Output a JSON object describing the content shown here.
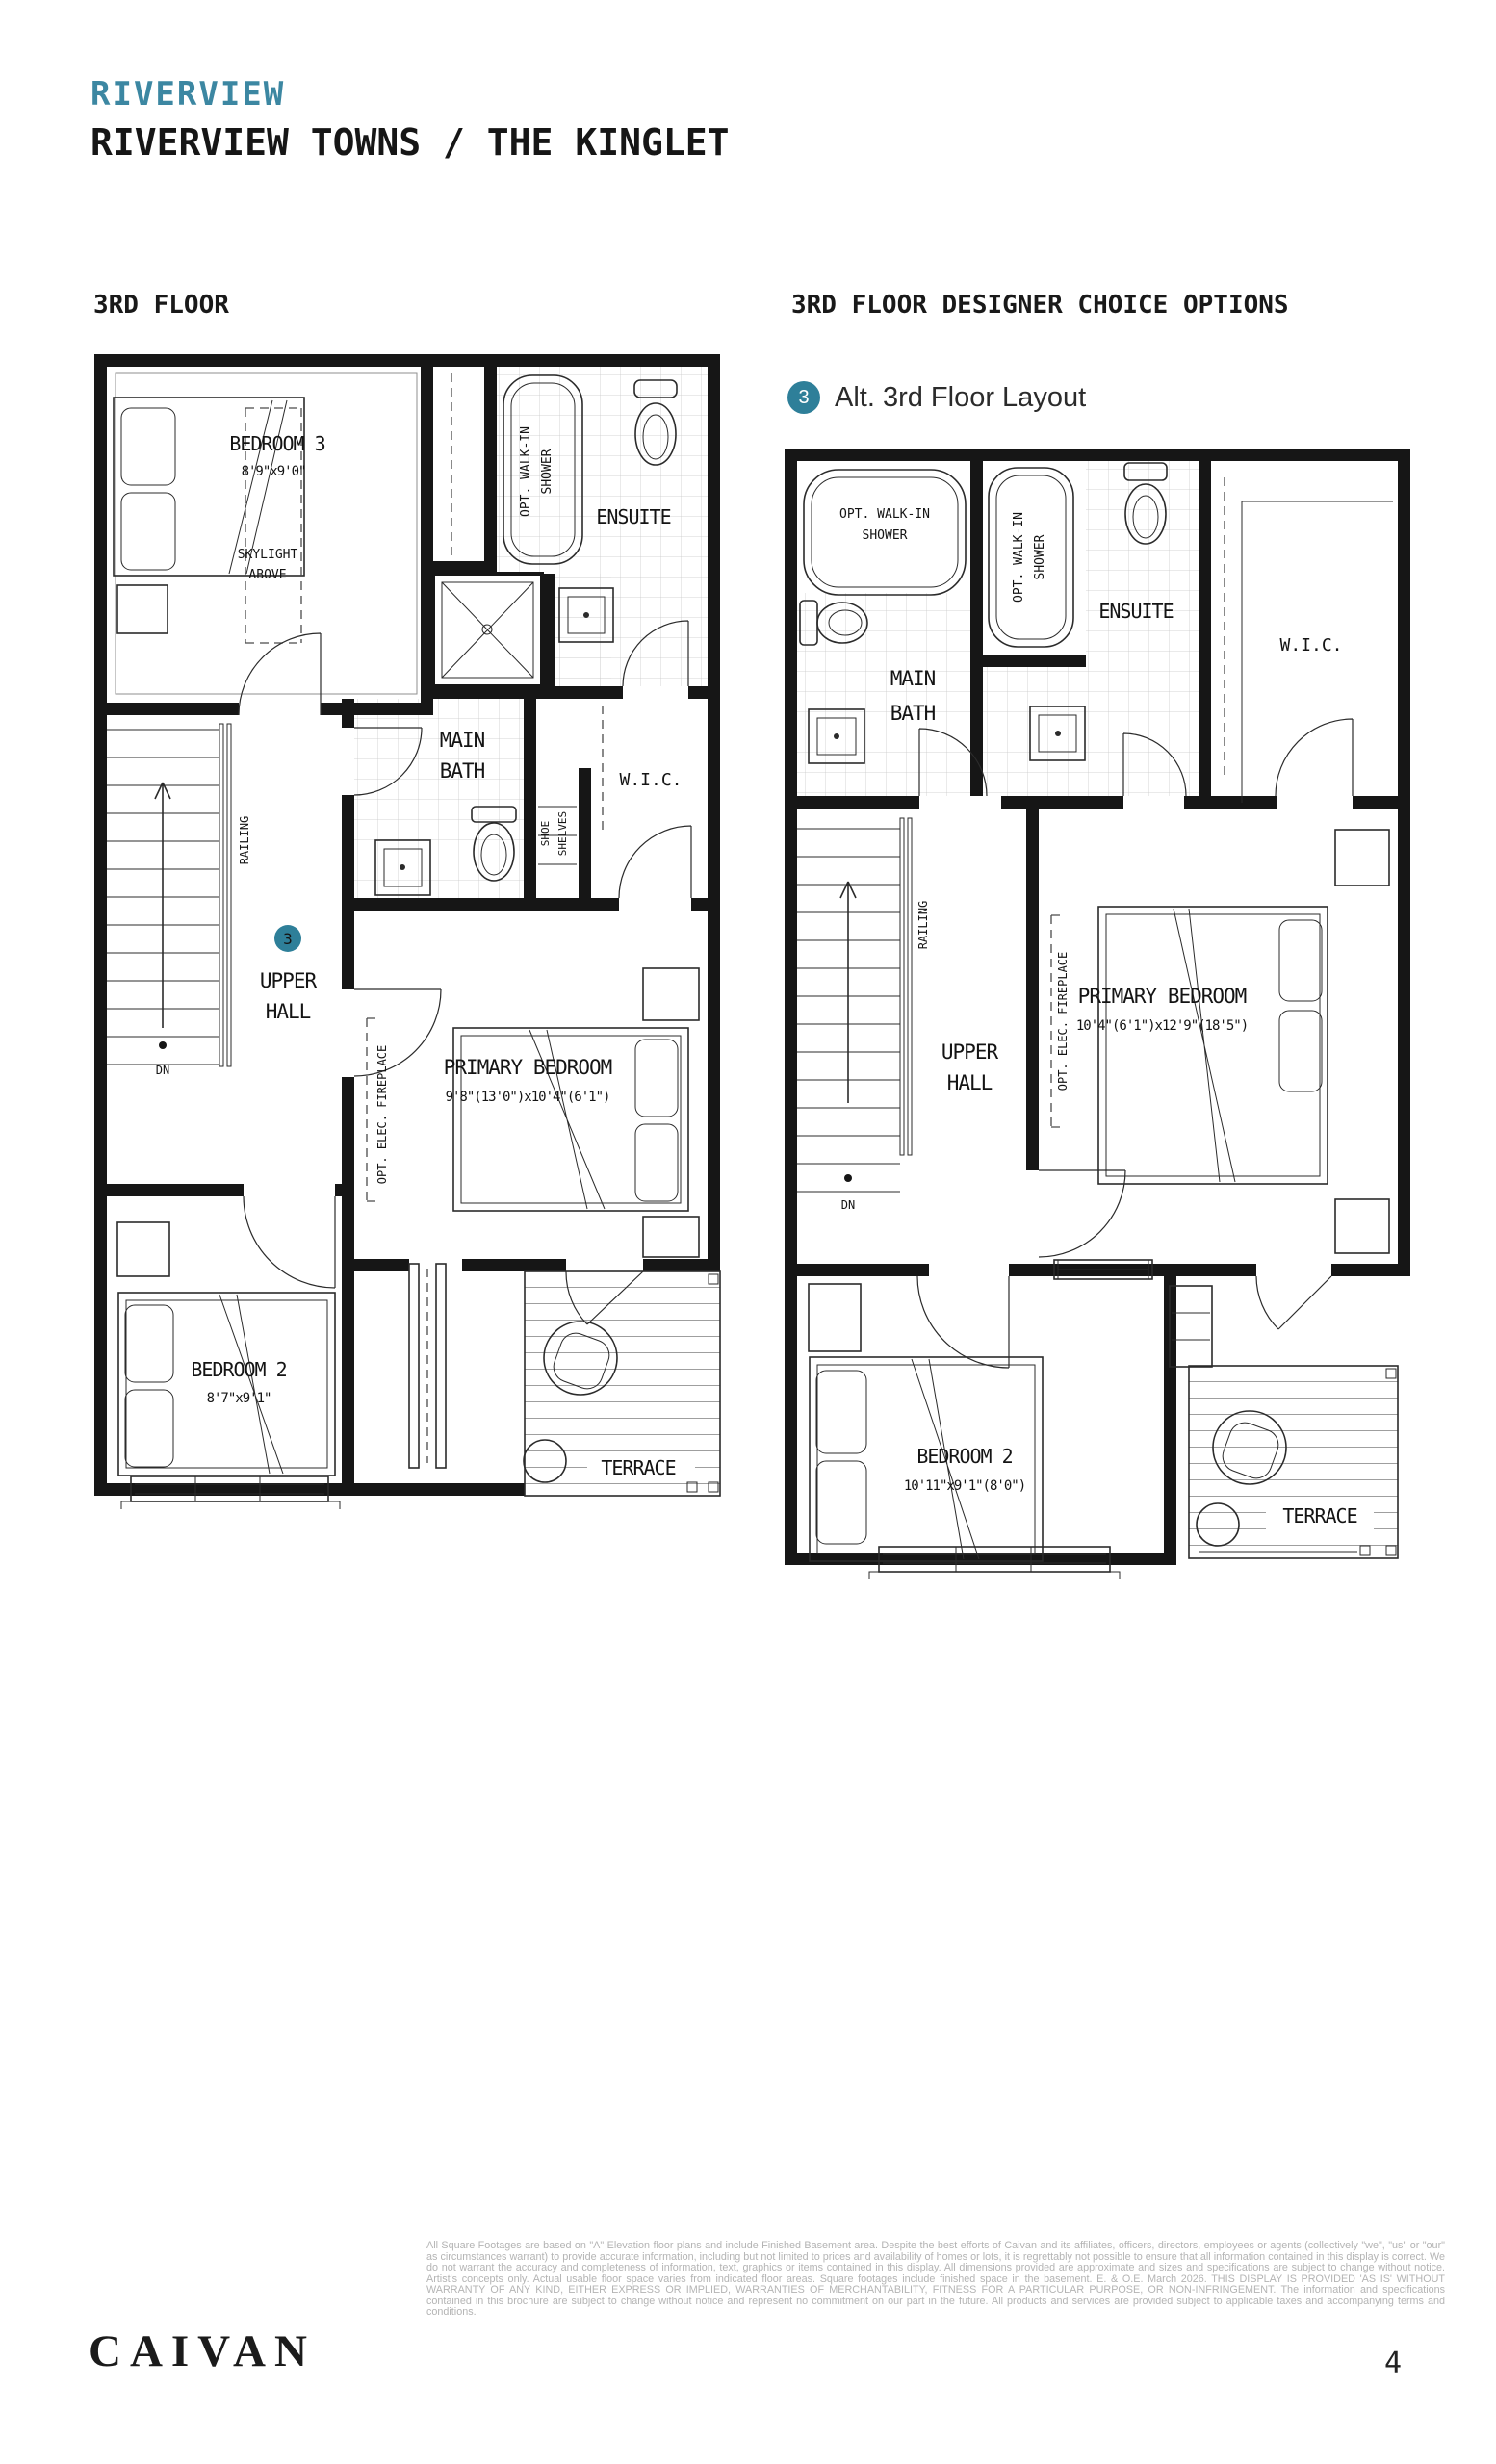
{
  "header": {
    "community": "RIVERVIEW",
    "title": "RIVERVIEW TOWNS / THE KINGLET"
  },
  "left_plan": {
    "heading": "3RD FLOOR",
    "badge": "3",
    "labels": {
      "bedroom3": [
        "BEDROOM 3",
        "8'9\"x9'0\""
      ],
      "skylight": [
        "SKYLIGHT",
        "ABOVE"
      ],
      "opt_walkin_shower": [
        "OPT. WALK-IN",
        "SHOWER"
      ],
      "ensuite": "ENSUITE",
      "main_bath": [
        "MAIN",
        "BATH"
      ],
      "wic": "W.I.C.",
      "shoe_shelves": [
        "SHOE",
        "SHELVES"
      ],
      "railing": "RAILING",
      "dn": "DN",
      "upper_hall": [
        "UPPER",
        "HALL"
      ],
      "primary_bedroom": [
        "PRIMARY BEDROOM",
        "9'8\"(13'0\")x10'4\"(6'1\")"
      ],
      "opt_elec_fireplace": "OPT. ELEC. FIREPLACE",
      "bedroom2": [
        "BEDROOM 2",
        "8'7\"x9'1\""
      ],
      "terrace": "TERRACE"
    }
  },
  "right_plan": {
    "heading": "3RD FLOOR DESIGNER CHOICE OPTIONS",
    "legend": {
      "badge": "3",
      "label": "Alt. 3rd Floor Layout"
    },
    "labels": {
      "opt_walkin_shower_main": [
        "OPT. WALK-IN",
        "SHOWER"
      ],
      "main_bath": [
        "MAIN",
        "BATH"
      ],
      "opt_walkin_shower_ensuite": [
        "OPT. WALK-IN",
        "SHOWER"
      ],
      "ensuite": "ENSUITE",
      "wic": "W.I.C.",
      "railing": "RAILING",
      "dn": "DN",
      "upper_hall": [
        "UPPER",
        "HALL"
      ],
      "opt_elec_fireplace": "OPT. ELEC. FIREPLACE",
      "primary_bedroom": [
        "PRIMARY BEDROOM",
        "10'4\"(6'1\")x12'9\"(18'5\")"
      ],
      "bedroom2": [
        "BEDROOM 2",
        "10'11\"x9'1\"(8'0\")"
      ],
      "terrace": "TERRACE"
    }
  },
  "footer": {
    "brand": "CAIVAN",
    "page_number": "4",
    "disclaimer": "All Square Footages are based on \"A\" Elevation floor plans and include Finished Basement area. Despite the best efforts of Caivan and its affiliates, officers, directors, employees or agents (collectively \"we\", \"us\" or \"our\" as circumstances warrant) to provide accurate information, including but not limited to prices and availability of homes or lots, it is regrettably not possible to ensure that all information contained in this display is correct. We do not warrant the accuracy and completeness of information, text, graphics or items contained in this display. All dimensions provided are approximate and sizes and specifications are subject to change without notice. Artist's concepts only. Actual usable floor space varies from indicated floor areas. Square footages include finished space in the basement. E. & O.E. March 2026. THIS DISPLAY IS PROVIDED 'AS IS' WITHOUT WARRANTY OF ANY KIND, EITHER EXPRESS OR IMPLIED, WARRANTIES OF MERCHANTABILITY, FITNESS FOR A PARTICULAR PURPOSE, OR NON-INFRINGEMENT. The information and specifications contained in this brochure are subject to change without notice and represent no commitment on our part in the future. All products and services are provided subject to applicable taxes and accompanying terms and conditions."
  },
  "colors": {
    "accent": "#2e7f99",
    "heading_accent": "#3c87a2"
  }
}
